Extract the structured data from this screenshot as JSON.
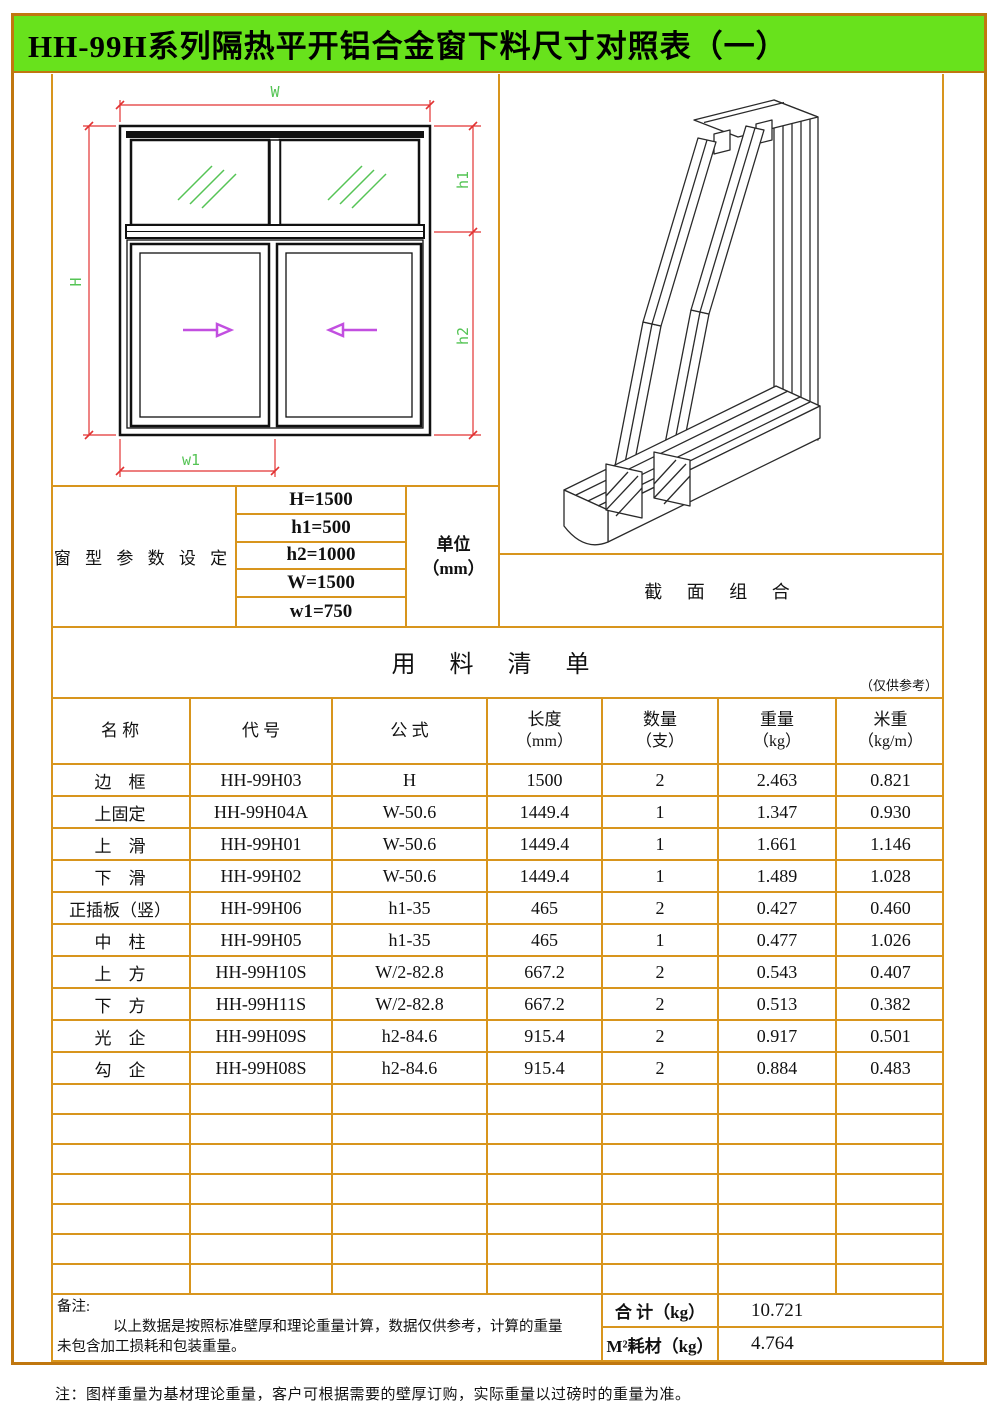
{
  "page": {
    "title": "HH-99H系列隔热平开铝合金窗下料尺寸对照表（一）",
    "footnote": "注：图样重量为基材理论重量，客户可根据需要的壁厚订购，实际重量以过磅时的重量为准。"
  },
  "colors": {
    "border_orange": "#c0770f",
    "grid_orange": "#d8951d",
    "title_green": "#68e21c",
    "dimension_red": "#e23333",
    "dimension_green": "#55c455",
    "arrow_magenta": "#c24fe0"
  },
  "diagram": {
    "dim_labels": {
      "W": "W",
      "H": "H",
      "h1": "h1",
      "h2": "h2",
      "w1": "w1"
    },
    "section_caption": "截 面 组 合"
  },
  "parameters": {
    "label": "窗 型 参 数 设 定",
    "values": [
      "H=1500",
      "h1=500",
      "h2=1000",
      "W=1500",
      "w1=750"
    ],
    "unit_line1": "单位",
    "unit_line2": "（mm）"
  },
  "bom": {
    "title": "用 料 清 单",
    "reference_note": "（仅供参考）",
    "headers": [
      {
        "line1": "名 称",
        "line2": ""
      },
      {
        "line1": "代 号",
        "line2": ""
      },
      {
        "line1": "公 式",
        "line2": ""
      },
      {
        "line1": "长度",
        "line2": "（mm）"
      },
      {
        "line1": "数量",
        "line2": "（支）"
      },
      {
        "line1": "重量",
        "line2": "（kg）"
      },
      {
        "line1": "米重",
        "line2": "（kg/m）"
      }
    ],
    "rows": [
      [
        "边　框",
        "HH-99H03",
        "H",
        "1500",
        "2",
        "2.463",
        "0.821"
      ],
      [
        "上固定",
        "HH-99H04A",
        "W-50.6",
        "1449.4",
        "1",
        "1.347",
        "0.930"
      ],
      [
        "上　滑",
        "HH-99H01",
        "W-50.6",
        "1449.4",
        "1",
        "1.661",
        "1.146"
      ],
      [
        "下　滑",
        "HH-99H02",
        "W-50.6",
        "1449.4",
        "1",
        "1.489",
        "1.028"
      ],
      [
        "正插板（竖）",
        "HH-99H06",
        "h1-35",
        "465",
        "2",
        "0.427",
        "0.460"
      ],
      [
        "中　柱",
        "HH-99H05",
        "h1-35",
        "465",
        "1",
        "0.477",
        "1.026"
      ],
      [
        "上　方",
        "HH-99H10S",
        "W/2-82.8",
        "667.2",
        "2",
        "0.543",
        "0.407"
      ],
      [
        "下　方",
        "HH-99H11S",
        "W/2-82.8",
        "667.2",
        "2",
        "0.513",
        "0.382"
      ],
      [
        "光　企",
        "HH-99H09S",
        "h2-84.6",
        "915.4",
        "2",
        "0.917",
        "0.501"
      ],
      [
        "勾　企",
        "HH-99H08S",
        "h2-84.6",
        "915.4",
        "2",
        "0.884",
        "0.483"
      ]
    ],
    "empty_row_count": 7,
    "remark_label": "备注:",
    "remark_line1": "以上数据是按照标准壁厚和理论重量计算，数据仅供参考，计算的重量",
    "remark_line2": "未包含加工损耗和包装重量。",
    "total_label": "合 计（kg）",
    "total_value": "10.721",
    "per_sqm_label": "M²耗材（kg）",
    "per_sqm_value": "4.764"
  }
}
